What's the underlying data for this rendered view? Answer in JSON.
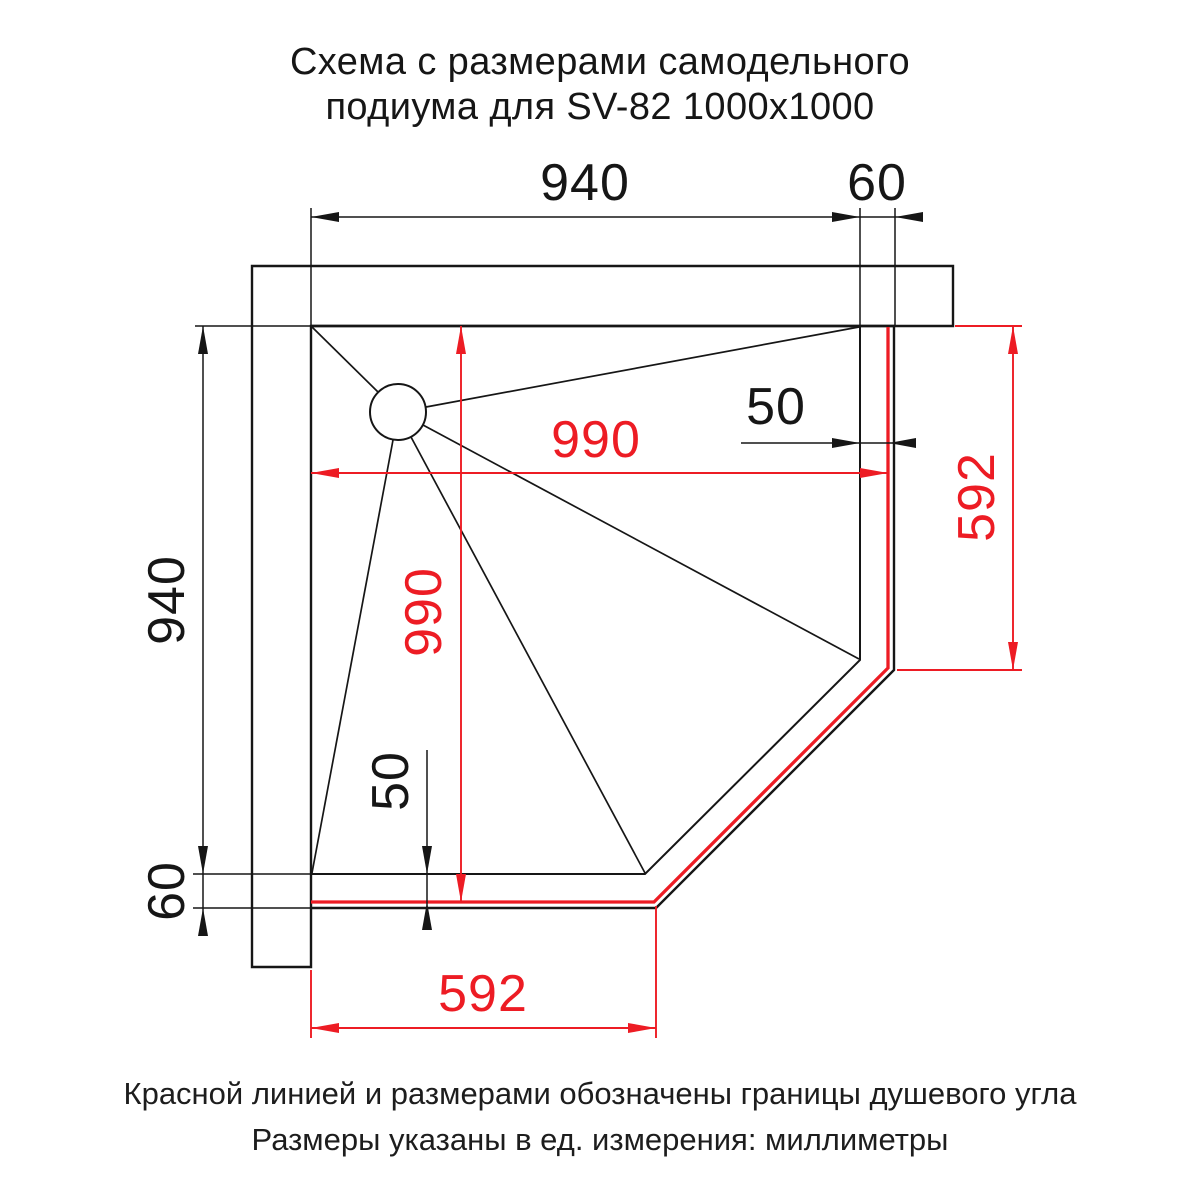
{
  "title": {
    "line1": "Схема с размерами самодельного",
    "line2": "подиума для SV-82 1000x1000"
  },
  "diagram": {
    "dimensions": {
      "podium_width_top": "940",
      "podium_edge_top": "60",
      "podium_depth_left": "940",
      "podium_edge_bottom": "60",
      "shower_corner_width": "990",
      "shower_corner_depth": "990",
      "tray_offset_right": "50",
      "tray_offset_bottom": "50",
      "corner_cut_right": "592",
      "corner_cut_bottom": "592"
    },
    "colors": {
      "boundary_red": "#ed1c24",
      "drawing_black": "#161616"
    }
  },
  "footer": {
    "line1": "Красной линией и размерами обозначены границы душевого угла",
    "line2": "Размеры указаны в ед. измерения: миллиметры"
  }
}
